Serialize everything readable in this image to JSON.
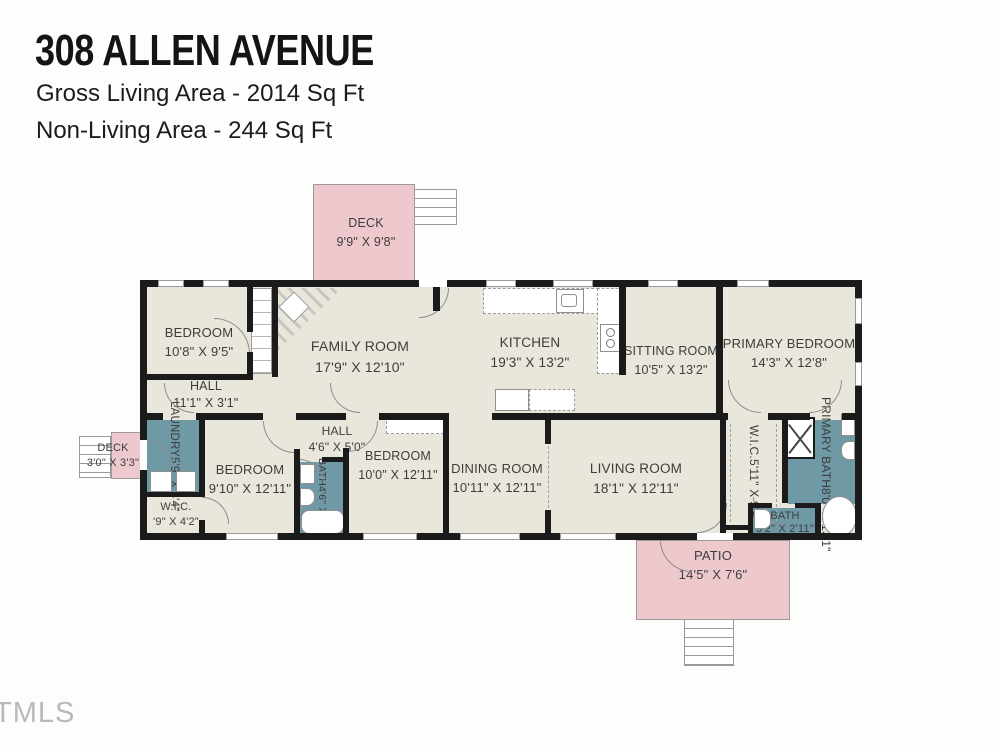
{
  "header": {
    "title": "308 ALLEN AVENUE",
    "gross_living": "Gross Living Area - 2014 Sq Ft",
    "non_living": "Non-Living Area - 244 Sq Ft"
  },
  "watermark": "TMLS",
  "colors": {
    "floor": "#e9e6db",
    "outdoor_pink": "#edc9cd",
    "wet_teal": "#6f99a5",
    "wall": "#1b1b1b",
    "label_text": "#3d3d3d"
  },
  "rooms": {
    "deck_top": {
      "name": "DECK",
      "dims": "9'9\" X 9'8\""
    },
    "bedroom_top_left": {
      "name": "BEDROOM",
      "dims": "10'8\" X 9'5\""
    },
    "hall_top": {
      "name": "HALL",
      "dims": "11'1\" X 3'1\""
    },
    "family_room": {
      "name": "FAMILY ROOM",
      "dims": "17'9\" X 12'10\""
    },
    "kitchen": {
      "name": "KITCHEN",
      "dims": "19'3\" X 13'2\""
    },
    "sitting_room": {
      "name": "SITTING ROOM",
      "dims": "10'5\" X 13'2\""
    },
    "primary_bedroom": {
      "name": "PRIMARY BEDROOM",
      "dims": "14'3\" X 12'8\""
    },
    "deck_left": {
      "name": "DECK",
      "dims": "3'0\" X 3'3\""
    },
    "laundry": {
      "name": "LAUNDRY",
      "dims": "5'9\" X 8'4\""
    },
    "wic_left": {
      "name": "W.I.C.",
      "dims": "'9\" X 4'2\""
    },
    "bedroom_bottom_left": {
      "name": "BEDROOM",
      "dims": "9'10\" X 12'11\""
    },
    "hall_bottom": {
      "name": "HALL",
      "dims": "4'6\" X 5'0\""
    },
    "bath_hall": {
      "name": "BATH",
      "dims": "4'6\" X 7'6\""
    },
    "bedroom_bottom_mid": {
      "name": "BEDROOM",
      "dims": "10'0\" X 12'11\""
    },
    "dining_room": {
      "name": "DINING ROOM",
      "dims": "10'11\" X 12'11\""
    },
    "living_room": {
      "name": "LIVING ROOM",
      "dims": "18'1\" X 12'11\""
    },
    "wic_right": {
      "name": "W.I.C.",
      "dims": "5'11\" X 9'9\""
    },
    "primary_bath": {
      "name": "PRIMARY BATH",
      "dims": "8'0\" X 13'1\""
    },
    "bath_small": {
      "name": "BATH",
      "dims": "5'2\" X 2'11\""
    },
    "patio": {
      "name": "PATIO",
      "dims": "14'5\" X 7'6\""
    }
  }
}
